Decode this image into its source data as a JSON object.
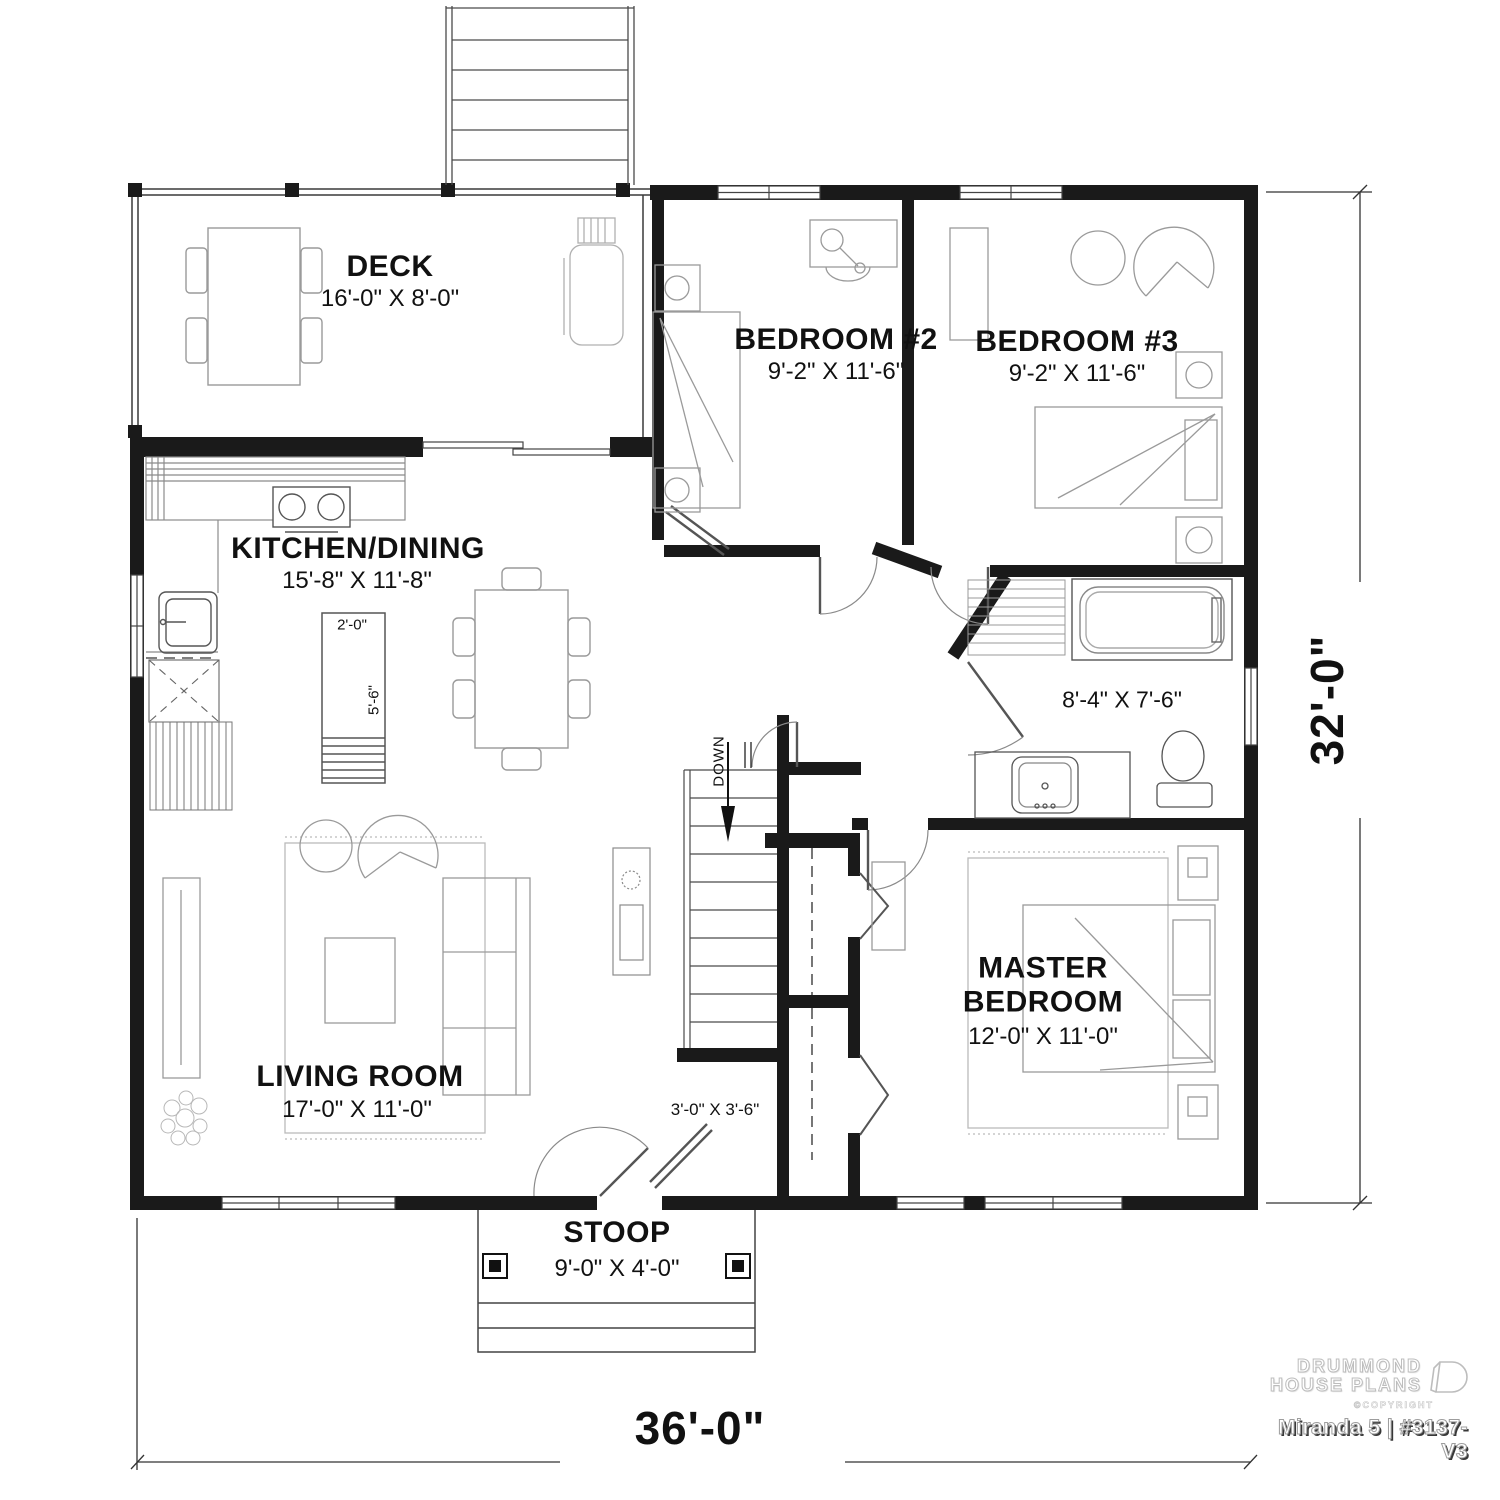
{
  "floor_plan": {
    "rooms": {
      "deck": {
        "name": "DECK",
        "dims": "16'-0\" X 8'-0\""
      },
      "bedroom2": {
        "name": "BEDROOM #2",
        "dims": "9'-2\" X 11'-6\""
      },
      "bedroom3": {
        "name": "BEDROOM #3",
        "dims": "9'-2\" X 11'-6\""
      },
      "kitchen_dining": {
        "name": "KITCHEN/DINING",
        "dims": "15'-8\" X 11'-8\""
      },
      "bathroom": {
        "dims": "8'-4\" X 7'-6\""
      },
      "master_bedroom": {
        "name": "MASTER BEDROOM",
        "dims": "12'-0\" X 11'-0\""
      },
      "living_room": {
        "name": "LIVING ROOM",
        "dims": "17'-0\" X 11'-0\""
      },
      "stoop": {
        "name": "STOOP",
        "dims": "9'-0\" X 4'-0\""
      },
      "entry_closet": {
        "dims": "3'-0\" X 3'-6\""
      }
    },
    "kitchen_island": {
      "width": "2'-0\"",
      "length": "5'-6\""
    },
    "stairs": {
      "direction_label": "DOWN"
    },
    "overall_dimensions": {
      "width": "36'-0\"",
      "depth": "32'-0\""
    },
    "branding": {
      "line1": "DRUMMOND",
      "line2": "HOUSE PLANS",
      "copyright": "©COPYRIGHT",
      "plan_id": "Miranda 5 | #3137-V3"
    }
  }
}
